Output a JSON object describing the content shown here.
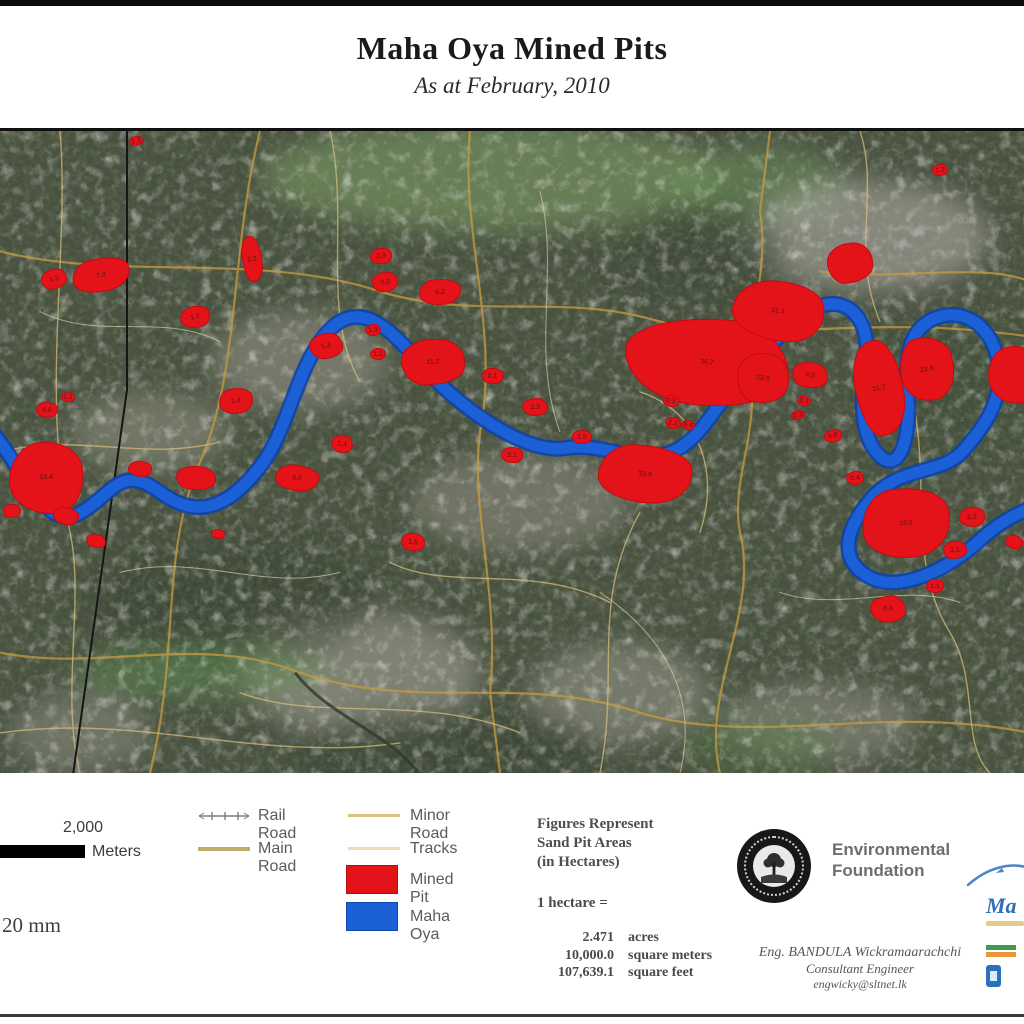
{
  "page": {
    "title": "Maha Oya Mined Pits",
    "subtitle": "As at February, 2010"
  },
  "map": {
    "colors": {
      "mined_pit": "#e41319",
      "maha_oya": "#1c60d8",
      "main_road": "#c99b3f",
      "minor_road": "#dcc07c",
      "tracks": "#ecdfb6",
      "rail_road": "#7d7d7d"
    },
    "pits": [
      {
        "x": 5.3,
        "y": 23.0,
        "w": 26,
        "h": 20,
        "area_ha": "1.3"
      },
      {
        "x": 9.9,
        "y": 22.5,
        "w": 58,
        "h": 34,
        "area_ha": "7.3"
      },
      {
        "x": 13.3,
        "y": 1.5,
        "w": 14,
        "h": 10,
        "area_ha": "1.1"
      },
      {
        "x": 19.0,
        "y": 29.0,
        "w": 30,
        "h": 22,
        "area_ha": "1.7"
      },
      {
        "x": 24.6,
        "y": 20.0,
        "w": 20,
        "h": 46,
        "area_ha": "3.3"
      },
      {
        "x": 23.0,
        "y": 42.0,
        "w": 34,
        "h": 26,
        "area_ha": "3.4"
      },
      {
        "x": 31.8,
        "y": 33.5,
        "w": 34,
        "h": 26,
        "area_ha": "5.4"
      },
      {
        "x": 37.2,
        "y": 19.5,
        "w": 22,
        "h": 16,
        "area_ha": "2.3"
      },
      {
        "x": 37.6,
        "y": 23.5,
        "w": 26,
        "h": 20,
        "area_ha": "3.3"
      },
      {
        "x": 43.0,
        "y": 25.0,
        "w": 42,
        "h": 26,
        "area_ha": "5.2"
      },
      {
        "x": 36.4,
        "y": 31.0,
        "w": 16,
        "h": 12,
        "area_ha": "1.9"
      },
      {
        "x": 36.9,
        "y": 34.8,
        "w": 16,
        "h": 12,
        "area_ha": "1.1"
      },
      {
        "x": 42.3,
        "y": 36.0,
        "w": 64,
        "h": 46,
        "area_ha": "11.7"
      },
      {
        "x": 48.1,
        "y": 38.2,
        "w": 22,
        "h": 16,
        "area_ha": "0.1"
      },
      {
        "x": 52.2,
        "y": 43.0,
        "w": 26,
        "h": 18,
        "area_ha": "3.3"
      },
      {
        "x": 50.0,
        "y": 50.5,
        "w": 22,
        "h": 16,
        "area_ha": "3.1"
      },
      {
        "x": 56.8,
        "y": 47.6,
        "w": 20,
        "h": 14,
        "area_ha": "1.0"
      },
      {
        "x": 63.0,
        "y": 53.5,
        "w": 94,
        "h": 58,
        "area_ha": "33.8"
      },
      {
        "x": 69.0,
        "y": 36.0,
        "w": 165,
        "h": 88,
        "area_ha": "36.7"
      },
      {
        "x": 76.0,
        "y": 28.0,
        "w": 92,
        "h": 60,
        "area_ha": "31.1"
      },
      {
        "x": 74.5,
        "y": 38.5,
        "w": 52,
        "h": 50,
        "area_ha": "13.5"
      },
      {
        "x": 65.5,
        "y": 42.0,
        "w": 16,
        "h": 12,
        "area_ha": "0.5"
      },
      {
        "x": 65.7,
        "y": 45.5,
        "w": 16,
        "h": 12,
        "area_ha": "2.1"
      },
      {
        "x": 67.2,
        "y": 45.8,
        "w": 14,
        "h": 10,
        "area_ha": "0.4"
      },
      {
        "x": 79.1,
        "y": 38.0,
        "w": 36,
        "h": 26,
        "area_ha": "4.0"
      },
      {
        "x": 78.5,
        "y": 42.0,
        "w": 14,
        "h": 10,
        "area_ha": "0.1"
      },
      {
        "x": 77.9,
        "y": 44.2,
        "w": 14,
        "h": 10,
        "area_ha": "0.3"
      },
      {
        "x": 81.3,
        "y": 47.5,
        "w": 18,
        "h": 13,
        "area_ha": "0.8"
      },
      {
        "x": 85.8,
        "y": 40.0,
        "w": 48,
        "h": 96,
        "area_ha": "21.7"
      },
      {
        "x": 90.5,
        "y": 37.0,
        "w": 54,
        "h": 64,
        "area_ha": "22.6"
      },
      {
        "x": 91.8,
        "y": 6.0,
        "w": 16,
        "h": 12,
        "area_ha": "1.2"
      },
      {
        "x": 99.0,
        "y": 38.0,
        "w": 52,
        "h": 58,
        "area_ha": ""
      },
      {
        "x": 83.0,
        "y": 20.5,
        "w": 46,
        "h": 40,
        "area_ha": ""
      },
      {
        "x": 88.5,
        "y": 61.0,
        "w": 88,
        "h": 70,
        "area_ha": "18.6"
      },
      {
        "x": 83.5,
        "y": 54.0,
        "w": 18,
        "h": 14,
        "area_ha": "0.4"
      },
      {
        "x": 94.9,
        "y": 60.2,
        "w": 26,
        "h": 20,
        "area_ha": "2.2"
      },
      {
        "x": 93.3,
        "y": 65.2,
        "w": 24,
        "h": 18,
        "area_ha": "3.1"
      },
      {
        "x": 91.3,
        "y": 70.9,
        "w": 18,
        "h": 14,
        "area_ha": "1.1"
      },
      {
        "x": 86.7,
        "y": 74.5,
        "w": 36,
        "h": 27,
        "area_ha": "8.4"
      },
      {
        "x": 4.5,
        "y": 54.0,
        "w": 74,
        "h": 72,
        "area_ha": "13.4"
      },
      {
        "x": 1.2,
        "y": 59.2,
        "w": 18,
        "h": 14,
        "area_ha": ""
      },
      {
        "x": 4.6,
        "y": 43.5,
        "w": 22,
        "h": 16,
        "area_ha": "4.6"
      },
      {
        "x": 6.6,
        "y": 41.4,
        "w": 14,
        "h": 10,
        "area_ha": "1.1"
      },
      {
        "x": 13.7,
        "y": 52.7,
        "w": 24,
        "h": 16,
        "area_ha": ""
      },
      {
        "x": 19.1,
        "y": 54.1,
        "w": 40,
        "h": 24,
        "area_ha": ""
      },
      {
        "x": 29.0,
        "y": 54.0,
        "w": 44,
        "h": 26,
        "area_ha": "8.0"
      },
      {
        "x": 33.4,
        "y": 48.7,
        "w": 22,
        "h": 18,
        "area_ha": "1.4"
      },
      {
        "x": 21.3,
        "y": 62.7,
        "w": 14,
        "h": 10,
        "area_ha": ""
      },
      {
        "x": 40.3,
        "y": 64.0,
        "w": 24,
        "h": 18,
        "area_ha": "1.5"
      },
      {
        "x": 6.4,
        "y": 60.0,
        "w": 26,
        "h": 18,
        "area_ha": ""
      },
      {
        "x": 9.4,
        "y": 63.8,
        "w": 20,
        "h": 14,
        "area_ha": ""
      },
      {
        "x": 99.0,
        "y": 64.0,
        "w": 18,
        "h": 14,
        "area_ha": ""
      }
    ]
  },
  "legend": {
    "items": [
      {
        "label": "Rail Road"
      },
      {
        "label": "Minor Road"
      },
      {
        "label": "Main Road"
      },
      {
        "label": "Tracks"
      },
      {
        "label": "Mined Pit"
      },
      {
        "label": "Maha Oya"
      }
    ],
    "scale": {
      "distance": "2,000",
      "unit": "Meters",
      "print_note": "20 mm"
    }
  },
  "info": {
    "figures_note_line1": "Figures Represent",
    "figures_note_line2": "Sand Pit Areas",
    "figures_note_line3": "(in Hectares)",
    "hectare_heading": "1 hectare =",
    "conversions": [
      {
        "value": "2.471",
        "unit": "acres"
      },
      {
        "value": "10,000.0",
        "unit": "square meters"
      },
      {
        "value": "107,639.1",
        "unit": "square feet"
      }
    ]
  },
  "credits": {
    "org_name_line1": "Environmental",
    "org_name_line2": "Foundation",
    "engineer": "Eng. BANDULA Wickramaarachchi",
    "engineer_title": "Consultant Engineer",
    "engineer_email": "engwicky@sltnet.lk",
    "right_logo_fragment": "Ma"
  }
}
